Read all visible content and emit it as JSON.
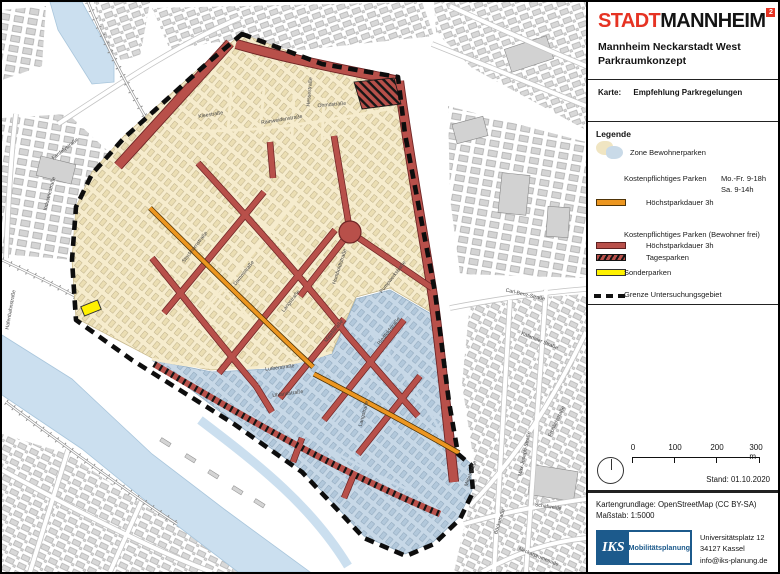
{
  "header": {
    "logo_part1": "STADT",
    "logo_part2": "MANNHEIM",
    "logo_sup": "2",
    "subtitle_line1": "Mannheim Neckarstadt West",
    "subtitle_line2": "Parkraumkonzept",
    "map_label": "Karte:",
    "map_name": "Empfehlung Parkregelungen"
  },
  "legend": {
    "heading": "Legende",
    "zone_label": "Zone Bewohnerparken",
    "paid_header": "Kostenpflichtiges Parken",
    "paid_time1": "Mo.-Fr. 9-18h",
    "paid_time2": "Sa. 9-14h",
    "paid_sub": "Höchstparkdauer 3h",
    "paid_res_header": "Kostenpflichtiges Parken (Bewohner frei)",
    "paid_res_sub1": "Höchstparkdauer 3h",
    "paid_res_sub2": "Tagesparken",
    "special_label": "Sonderparken",
    "boundary_label": "Grenze Untersuchungsgebiet"
  },
  "scalebar": {
    "ticks": [
      "0",
      "100",
      "200",
      "300 m"
    ],
    "stand": "Stand: 01.10.2020"
  },
  "credits": {
    "source": "Kartengrundlage: OpenStreetMap (CC BY-SA)",
    "scale": "Maßstab: 1:5000"
  },
  "publisher": {
    "brand": "IKS",
    "brand_suffix": "Mobilitätsplanung",
    "address1": "Universitätsplatz 12",
    "address2": "34127 Kassel",
    "address3": "info@iks-planung.de"
  },
  "map": {
    "colors": {
      "zone_resident_beige": "#F6ECCD",
      "zone_resident_blue": "#C7D8E7",
      "paid_orange": "#EC9620",
      "paid_resident_free_red": "#B8504A",
      "special_yellow": "#FFF100",
      "boundary_black": "#0D0D0D",
      "water_blue": "#CBDFEF",
      "stadt_red": "#E63323",
      "iks_blue": "#1C5A8C"
    },
    "street_labels": [
      {
        "text": "Industriestraße",
        "x": 49,
        "y": 192,
        "r": -75
      },
      {
        "text": "Fardelystraße",
        "x": 64,
        "y": 148,
        "r": -38
      },
      {
        "text": "Hafenbahnstraße",
        "x": 10,
        "y": 308,
        "r": -80,
        "s": 4.6
      },
      {
        "text": "Kleestraße",
        "x": 209,
        "y": 114,
        "r": -9
      },
      {
        "text": "Rainweidenstraße",
        "x": 280,
        "y": 119,
        "r": -9
      },
      {
        "text": "Ohmdstraße",
        "x": 330,
        "y": 104,
        "r": -5
      },
      {
        "text": "Hessestraße",
        "x": 309,
        "y": 90,
        "r": -85,
        "s": 4.8
      },
      {
        "text": "Stockhornstraße",
        "x": 194,
        "y": 246,
        "r": -52,
        "s": 4.8
      },
      {
        "text": "Dammstraße",
        "x": 243,
        "y": 272,
        "r": -52
      },
      {
        "text": "Langstraße",
        "x": 290,
        "y": 300,
        "r": -52
      },
      {
        "text": "Mittelstraße",
        "x": 333,
        "y": 330,
        "r": -52,
        "s": 4.8
      },
      {
        "text": "Humboldtstraße",
        "x": 339,
        "y": 265,
        "r": -72,
        "s": 4.8
      },
      {
        "text": "Pumpwerkstraße",
        "x": 392,
        "y": 276,
        "r": -52,
        "s": 4.8
      },
      {
        "text": "Lutherstraße",
        "x": 278,
        "y": 367,
        "r": -7
      },
      {
        "text": "Uhlandstraße",
        "x": 286,
        "y": 393,
        "r": -8,
        "s": 4.8
      },
      {
        "text": "Riedfeldstraße",
        "x": 388,
        "y": 330,
        "r": -52,
        "s": 4.8
      },
      {
        "text": "Langstraße",
        "x": 363,
        "y": 412,
        "r": -75,
        "s": 4.8
      },
      {
        "text": "Carl-Benz-Straße",
        "x": 523,
        "y": 294,
        "r": 13
      },
      {
        "text": "Käfertaler Straße",
        "x": 537,
        "y": 340,
        "r": 22,
        "s": 5
      },
      {
        "text": "Schafweide",
        "x": 546,
        "y": 506,
        "r": 8,
        "s": 5
      },
      {
        "text": "Böckstraße",
        "x": 499,
        "y": 520,
        "r": -72,
        "s": 5
      },
      {
        "text": "Max-Joseph-Straße",
        "x": 524,
        "y": 452,
        "r": -78,
        "s": 4.6
      },
      {
        "text": "Mittelstraße",
        "x": 470,
        "y": 472,
        "r": -70,
        "s": 4.6
      },
      {
        "text": "Fröhlichstraße",
        "x": 556,
        "y": 420,
        "r": -65,
        "s": 4.6
      },
      {
        "text": "Neckarpromenade",
        "x": 536,
        "y": 556,
        "r": 22,
        "s": 4.8
      }
    ]
  }
}
